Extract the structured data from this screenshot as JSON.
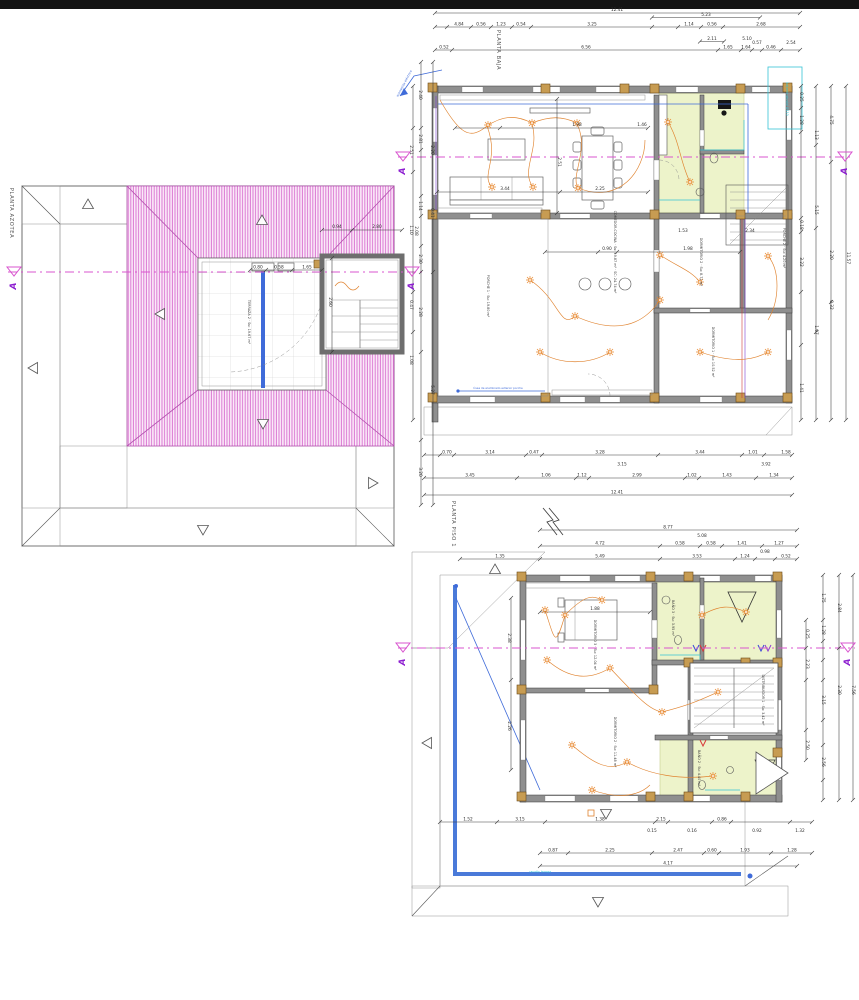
{
  "document": {
    "type": "architectural electrical floor plans",
    "background": "#ffffff",
    "top_bar_color": "#141414"
  },
  "colors": {
    "roof_hatch_pink": "#db7bd3",
    "eave_hatch_grey": "#a2a2a2",
    "wall_grey": "#8f8f8f",
    "column_tan": "#c79c52",
    "wet_room_green": "#edf3ca",
    "wiring_orange": "#e0832f",
    "gutter_blue": "#3f6bd9",
    "plumbing_cyan": "#35c3d5",
    "section_magenta": "#d955cf",
    "section_letter_purple": "#8d1fd0"
  },
  "plans": {
    "roof": {
      "title": "PLANTA AZOTEA"
    },
    "ground": {
      "title": "PLANTA BAJA"
    },
    "first": {
      "title": "PLANTA PISO 1"
    }
  },
  "section": {
    "letter": "A"
  },
  "section_markers": [
    {
      "x": 14,
      "y": 272
    },
    {
      "x": 412,
      "y": 272
    },
    {
      "x": 403,
      "y": 157
    },
    {
      "x": 845,
      "y": 157
    },
    {
      "x": 403,
      "y": 648
    },
    {
      "x": 848,
      "y": 648
    }
  ],
  "labels": [
    {
      "t": "12.41",
      "x": 617,
      "y": 11
    },
    {
      "t": "4.84",
      "x": 459,
      "y": 25.5
    },
    {
      "t": "0.56",
      "x": 481,
      "y": 25.5
    },
    {
      "t": "1.23",
      "x": 501,
      "y": 25.5
    },
    {
      "t": "0.54",
      "x": 521,
      "y": 25.5
    },
    {
      "t": "3.25",
      "x": 592,
      "y": 25.5
    },
    {
      "t": "5.23",
      "x": 706,
      "y": 16
    },
    {
      "t": "1.14",
      "x": 689,
      "y": 25.5
    },
    {
      "t": "0.56",
      "x": 712,
      "y": 25.5
    },
    {
      "t": "2.68",
      "x": 761,
      "y": 25.5
    },
    {
      "t": "2.11",
      "x": 712,
      "y": 40
    },
    {
      "t": "5.10",
      "x": 747,
      "y": 40
    },
    {
      "t": "0.52",
      "x": 444,
      "y": 48.5
    },
    {
      "t": "6.56",
      "x": 586,
      "y": 48.5
    },
    {
      "t": "1.65",
      "x": 728,
      "y": 48.5
    },
    {
      "t": "1.64",
      "x": 746,
      "y": 48.5
    },
    {
      "t": "0.57",
      "x": 757,
      "y": 44
    },
    {
      "t": "0.46",
      "x": 771,
      "y": 48.5
    },
    {
      "t": "2.54",
      "x": 791,
      "y": 44
    },
    {
      "t": "0.70",
      "x": 447,
      "y": 453.5
    },
    {
      "t": "3.14",
      "x": 490,
      "y": 453.5
    },
    {
      "t": "0.47",
      "x": 534,
      "y": 453.5
    },
    {
      "t": "3.28",
      "x": 600,
      "y": 453.5
    },
    {
      "t": "3.15",
      "x": 622,
      "y": 465.5
    },
    {
      "t": "3.44",
      "x": 700,
      "y": 453.5
    },
    {
      "t": "3.92",
      "x": 766,
      "y": 465.5
    },
    {
      "t": "1.01",
      "x": 753,
      "y": 453.5
    },
    {
      "t": "1.58",
      "x": 786,
      "y": 453.5
    },
    {
      "t": "3.45",
      "x": 470,
      "y": 476.5
    },
    {
      "t": "1.06",
      "x": 546,
      "y": 476.5
    },
    {
      "t": "1.12",
      "x": 582,
      "y": 476.5
    },
    {
      "t": "2.99",
      "x": 637,
      "y": 476.5
    },
    {
      "t": "1.02",
      "x": 692,
      "y": 476.5
    },
    {
      "t": "1.43",
      "x": 727,
      "y": 476.5
    },
    {
      "t": "1.34",
      "x": 774,
      "y": 476.5
    },
    {
      "t": "12.41",
      "x": 617,
      "y": 493.5
    },
    {
      "t": "0.25",
      "x": 800,
      "y": 97,
      "r": 90
    },
    {
      "t": "1.28",
      "x": 800,
      "y": 120,
      "r": 90
    },
    {
      "t": "1.13",
      "x": 815,
      "y": 135,
      "r": 90
    },
    {
      "t": "5.15",
      "x": 815,
      "y": 210,
      "r": 90
    },
    {
      "t": "0.18",
      "x": 800,
      "y": 225,
      "r": 90
    },
    {
      "t": "3.22",
      "x": 800,
      "y": 262,
      "r": 90
    },
    {
      "t": "1.97",
      "x": 815,
      "y": 330,
      "r": 90
    },
    {
      "t": "1.41",
      "x": 800,
      "y": 388,
      "r": 90
    },
    {
      "t": "2.20",
      "x": 830,
      "y": 255,
      "r": 90
    },
    {
      "t": "0.32",
      "x": 830,
      "y": 305,
      "r": 90
    },
    {
      "t": "4.75",
      "x": 830,
      "y": 120,
      "r": 90
    },
    {
      "t": "11.57",
      "x": 847,
      "y": 258,
      "r": 90
    },
    {
      "t": "2.51",
      "x": 410,
      "y": 150,
      "r": 90
    },
    {
      "t": "1.10",
      "x": 410,
      "y": 230,
      "r": 90
    },
    {
      "t": "0.47",
      "x": 410,
      "y": 305,
      "r": 90
    },
    {
      "t": "1.08",
      "x": 410,
      "y": 360,
      "r": 90
    },
    {
      "t": "1.98",
      "x": 577,
      "y": 126
    },
    {
      "t": "1.46",
      "x": 642,
      "y": 126
    },
    {
      "t": "3.44",
      "x": 505,
      "y": 190
    },
    {
      "t": "2.25",
      "x": 600,
      "y": 190
    },
    {
      "t": "2.51",
      "x": 558,
      "y": 162,
      "r": 90
    },
    {
      "t": "0.90",
      "x": 607,
      "y": 250
    },
    {
      "t": "1.98",
      "x": 688,
      "y": 250
    },
    {
      "t": "1.53",
      "x": 683,
      "y": 232
    },
    {
      "t": "2.34",
      "x": 750,
      "y": 232
    },
    {
      "t": "0.94",
      "x": 337,
      "y": 228
    },
    {
      "t": "2.80",
      "x": 377,
      "y": 228
    },
    {
      "t": "0.80",
      "x": 258,
      "y": 268.5
    },
    {
      "t": "0.58",
      "x": 279,
      "y": 268.5
    },
    {
      "t": "1.65",
      "x": 307,
      "y": 268.5
    },
    {
      "t": "2.60",
      "x": 329,
      "y": 302,
      "r": 90
    },
    {
      "t": "2.40",
      "x": 419,
      "y": 95,
      "r": 90
    },
    {
      "t": "2.81",
      "x": 419,
      "y": 139,
      "r": 90
    },
    {
      "t": "2.20",
      "x": 431,
      "y": 150,
      "r": 90
    },
    {
      "t": "1.14",
      "x": 419,
      "y": 206,
      "r": 90
    },
    {
      "t": "0.41",
      "x": 431,
      "y": 213,
      "r": 90
    },
    {
      "t": "2.08",
      "x": 415,
      "y": 231,
      "r": 90
    },
    {
      "t": "2.30",
      "x": 419,
      "y": 259,
      "r": 90
    },
    {
      "t": "2.28",
      "x": 419,
      "y": 312,
      "r": 90
    },
    {
      "t": "5.27",
      "x": 431,
      "y": 390,
      "r": 90
    },
    {
      "t": "3.20",
      "x": 419,
      "y": 472,
      "r": 90
    },
    {
      "t": "8.77",
      "x": 668,
      "y": 528.5
    },
    {
      "t": "4.72",
      "x": 600,
      "y": 544.5
    },
    {
      "t": "5.08",
      "x": 702,
      "y": 537
    },
    {
      "t": "0.58",
      "x": 680,
      "y": 544.5
    },
    {
      "t": "0.58",
      "x": 711,
      "y": 544.5
    },
    {
      "t": "1.41",
      "x": 742,
      "y": 544.5
    },
    {
      "t": "1.27",
      "x": 779,
      "y": 544.5
    },
    {
      "t": "1.35",
      "x": 500,
      "y": 557.5
    },
    {
      "t": "5.49",
      "x": 600,
      "y": 557.5
    },
    {
      "t": "3.53",
      "x": 697,
      "y": 557.5
    },
    {
      "t": "1.24",
      "x": 745,
      "y": 557.5
    },
    {
      "t": "0.98",
      "x": 765,
      "y": 553
    },
    {
      "t": "0.52",
      "x": 786,
      "y": 557.5
    },
    {
      "t": "1.52",
      "x": 468,
      "y": 820.5
    },
    {
      "t": "3.15",
      "x": 520,
      "y": 820.5
    },
    {
      "t": "1.38",
      "x": 600,
      "y": 820.5
    },
    {
      "t": "2.15",
      "x": 661,
      "y": 820.5
    },
    {
      "t": "0.86",
      "x": 722,
      "y": 820.5
    },
    {
      "t": "0.15",
      "x": 652,
      "y": 832
    },
    {
      "t": "0.16",
      "x": 692,
      "y": 832
    },
    {
      "t": "0.92",
      "x": 757,
      "y": 832
    },
    {
      "t": "1.32",
      "x": 800,
      "y": 832
    },
    {
      "t": "0.87",
      "x": 553,
      "y": 851.5
    },
    {
      "t": "2.25",
      "x": 610,
      "y": 851.5
    },
    {
      "t": "2.47",
      "x": 678,
      "y": 851.5
    },
    {
      "t": "0.60",
      "x": 712,
      "y": 851.5
    },
    {
      "t": "1.93",
      "x": 745,
      "y": 851.5
    },
    {
      "t": "1.28",
      "x": 792,
      "y": 851.5
    },
    {
      "t": "4.17",
      "x": 668,
      "y": 864.5
    },
    {
      "t": "1.75",
      "x": 822,
      "y": 598,
      "r": 90
    },
    {
      "t": "1.28",
      "x": 822,
      "y": 630,
      "r": 90
    },
    {
      "t": "0.25",
      "x": 806,
      "y": 634,
      "r": 90
    },
    {
      "t": "2.23",
      "x": 806,
      "y": 664,
      "r": 90
    },
    {
      "t": "3.15",
      "x": 822,
      "y": 700,
      "r": 90
    },
    {
      "t": "2.50",
      "x": 806,
      "y": 745,
      "r": 90
    },
    {
      "t": "2.56",
      "x": 822,
      "y": 762,
      "r": 90
    },
    {
      "t": "2.30",
      "x": 838,
      "y": 690,
      "r": 90
    },
    {
      "t": "7.56",
      "x": 852,
      "y": 690,
      "r": 90
    },
    {
      "t": "2.84",
      "x": 838,
      "y": 608,
      "r": 90
    },
    {
      "t": "2.38",
      "x": 508,
      "y": 638,
      "r": 90
    },
    {
      "t": "2.26",
      "x": 508,
      "y": 726,
      "r": 90
    },
    {
      "t": "1.88",
      "x": 595,
      "y": 610
    }
  ],
  "room_labels": [
    {
      "t": "TERRAZA 2 · Su: 19.67 m²",
      "x": 248,
      "y": 322,
      "r": 90
    },
    {
      "t": "PORCHE 1 · Su: 19.80 m²",
      "x": 487,
      "y": 296,
      "r": 90
    },
    {
      "t": "COMEDOR-COCINA · Su: 19.87 m² · SC: 24.74 m²",
      "x": 614,
      "y": 252,
      "r": 90
    },
    {
      "t": "DORMITORIO 1 · Su: 10.52 m²",
      "x": 712,
      "y": 352,
      "r": 90
    },
    {
      "t": "DORMITORIO 2 · Su: 8.71 m²",
      "x": 700,
      "y": 262,
      "r": 90
    },
    {
      "t": "PORCHE 2 · Su: 4.20 m²",
      "x": 783,
      "y": 248,
      "r": 90
    },
    {
      "t": "DORMITORIO 3 · Su: 12.04 m²",
      "x": 594,
      "y": 645,
      "r": 90
    },
    {
      "t": "DORMITORIO 2 · Su: 11.48 m²",
      "x": 614,
      "y": 742,
      "r": 90
    },
    {
      "t": "BAÑO 3 · Su: 3.95 m²",
      "x": 672,
      "y": 618,
      "r": 90
    },
    {
      "t": "BAÑO 2 · Su: 4.40 m²",
      "x": 698,
      "y": 768,
      "r": 90
    },
    {
      "t": "DISTRIBUIDOR 1 · Su: 3.42 m²",
      "x": 762,
      "y": 700,
      "r": 90
    }
  ],
  "notes": [
    {
      "t": "bajante pluvial Ø110",
      "x": 786,
      "y": 99,
      "r": 90,
      "c": "#35c3d5",
      "s": 3.2
    },
    {
      "t": "acometida eléctrica",
      "x": 405,
      "y": 84,
      "r": -62,
      "c": "#3f6bd9",
      "s": 3
    },
    {
      "t": "línea de alumbrado exterior porche",
      "x": 498,
      "y": 389.2,
      "c": "#3f6bd9",
      "s": 2.8
    },
    {
      "t": "canalón terraza",
      "x": 540,
      "y": 872.6,
      "c": "#35c3d5",
      "s": 2.8
    }
  ],
  "chains": [
    {
      "o": "h",
      "y": 13,
      "x1": 435,
      "x2": 800,
      "t": [
        435,
        800
      ]
    },
    {
      "o": "h",
      "y": 27,
      "x1": 435,
      "x2": 800,
      "t": [
        435,
        447,
        471,
        491,
        512,
        531,
        652,
        678,
        701,
        723,
        800
      ]
    },
    {
      "o": "h",
      "y": 50,
      "x1": 435,
      "x2": 800,
      "t": [
        435,
        452,
        718,
        741,
        752,
        762,
        781,
        800
      ]
    },
    {
      "o": "h",
      "y": 41.5,
      "x1": 700,
      "x2": 724,
      "t": [
        700,
        724
      ]
    },
    {
      "o": "h",
      "y": 17.5,
      "x1": 652,
      "x2": 760,
      "t": [
        652,
        760
      ]
    },
    {
      "o": "h",
      "y": 455,
      "x1": 424,
      "x2": 792,
      "t": [
        424,
        440,
        454,
        526,
        542,
        658,
        742,
        764,
        792
      ]
    },
    {
      "o": "h",
      "y": 478,
      "x1": 424,
      "x2": 792,
      "t": [
        424,
        517,
        576,
        589,
        685,
        699,
        756,
        792
      ]
    },
    {
      "o": "h",
      "y": 495,
      "x1": 424,
      "x2": 792,
      "t": [
        424,
        792
      ]
    },
    {
      "o": "v",
      "x": 801,
      "y1": 86,
      "y2": 420,
      "t": [
        86,
        108,
        132,
        218,
        232,
        292,
        345,
        420
      ]
    },
    {
      "o": "v",
      "x": 816,
      "y1": 86,
      "y2": 420,
      "t": [
        86,
        145,
        228,
        332,
        420
      ]
    },
    {
      "o": "v",
      "x": 831,
      "y1": 86,
      "y2": 420,
      "t": [
        86,
        162,
        302,
        420
      ]
    },
    {
      "o": "v",
      "x": 846,
      "y1": 86,
      "y2": 420,
      "t": [
        86,
        420
      ]
    },
    {
      "o": "v",
      "x": 413,
      "y1": 86,
      "y2": 420,
      "t": [
        86,
        128,
        172,
        292,
        332,
        420
      ]
    },
    {
      "o": "v",
      "x": 421,
      "y1": 62,
      "y2": 505,
      "t": [
        62,
        128,
        150,
        196,
        216,
        246,
        272,
        352,
        440,
        505
      ]
    },
    {
      "o": "v",
      "x": 433,
      "y1": 62,
      "y2": 505,
      "t": [
        62,
        272,
        505
      ]
    },
    {
      "o": "h",
      "y": 230,
      "x1": 322,
      "x2": 402,
      "t": [
        322,
        352,
        402
      ]
    },
    {
      "o": "h",
      "y": 270,
      "x1": 250,
      "x2": 322,
      "t": [
        250,
        266,
        292,
        322
      ]
    },
    {
      "o": "v",
      "x": 332,
      "y1": 258,
      "y2": 352,
      "t": [
        258,
        352
      ]
    },
    {
      "o": "h",
      "y": 128,
      "x1": 455,
      "x2": 648,
      "t": [
        455,
        500,
        648
      ]
    },
    {
      "o": "h",
      "y": 192,
      "x1": 437,
      "x2": 648,
      "t": [
        437,
        560,
        648
      ]
    },
    {
      "o": "v",
      "x": 557,
      "y1": 99,
      "y2": 213,
      "t": [
        99,
        213
      ]
    },
    {
      "o": "h",
      "y": 252,
      "x1": 545,
      "x2": 740,
      "t": [
        545,
        598,
        617,
        740
      ]
    },
    {
      "o": "h",
      "y": 530,
      "x1": 540,
      "x2": 797,
      "t": [
        540,
        797
      ]
    },
    {
      "o": "h",
      "y": 546,
      "x1": 540,
      "x2": 797,
      "t": [
        540,
        660,
        700,
        722,
        762,
        797
      ]
    },
    {
      "o": "h",
      "y": 559,
      "x1": 460,
      "x2": 797,
      "t": [
        460,
        540,
        660,
        735,
        755,
        775,
        797
      ]
    },
    {
      "o": "h",
      "y": 822,
      "x1": 440,
      "x2": 812,
      "t": [
        440,
        497,
        545,
        655,
        668,
        712,
        731,
        790,
        812
      ]
    },
    {
      "o": "h",
      "y": 853,
      "x1": 540,
      "x2": 812,
      "t": [
        540,
        568,
        652,
        704,
        719,
        771,
        812
      ]
    },
    {
      "o": "h",
      "y": 866,
      "x1": 540,
      "x2": 797,
      "t": [
        540,
        797
      ]
    },
    {
      "o": "v",
      "x": 806,
      "y1": 620,
      "y2": 760,
      "t": [
        620,
        648,
        680,
        730,
        760
      ]
    },
    {
      "o": "v",
      "x": 823,
      "y1": 575,
      "y2": 800,
      "t": [
        575,
        620,
        641,
        660,
        680,
        720,
        745,
        780,
        800
      ]
    },
    {
      "o": "v",
      "x": 839,
      "y1": 575,
      "y2": 800,
      "t": [
        575,
        648,
        800
      ]
    },
    {
      "o": "v",
      "x": 853,
      "y1": 575,
      "y2": 800,
      "t": [
        575,
        800
      ]
    },
    {
      "o": "v",
      "x": 511,
      "y1": 598,
      "y2": 770,
      "t": [
        598,
        680,
        770
      ]
    },
    {
      "o": "h",
      "y": 612,
      "x1": 540,
      "x2": 650,
      "t": [
        540,
        650
      ]
    }
  ],
  "lights": {
    "ground": [
      [
        488,
        125
      ],
      [
        532,
        123
      ],
      [
        577,
        123
      ],
      [
        492,
        187
      ],
      [
        533,
        187
      ],
      [
        578,
        188
      ],
      [
        668,
        122
      ],
      [
        690,
        182
      ],
      [
        530,
        280
      ],
      [
        575,
        316
      ],
      [
        660,
        300
      ],
      [
        700,
        282
      ],
      [
        768,
        256
      ],
      [
        700,
        352
      ],
      [
        768,
        352
      ],
      [
        610,
        352
      ],
      [
        540,
        352
      ],
      [
        660,
        255
      ]
    ],
    "first": [
      [
        565,
        615
      ],
      [
        602,
        600
      ],
      [
        547,
        660
      ],
      [
        610,
        668
      ],
      [
        572,
        745
      ],
      [
        627,
        762
      ],
      [
        662,
        712
      ],
      [
        718,
        692
      ],
      [
        702,
        615
      ],
      [
        746,
        612
      ],
      [
        713,
        776
      ],
      [
        592,
        790
      ],
      [
        545,
        610
      ]
    ]
  }
}
